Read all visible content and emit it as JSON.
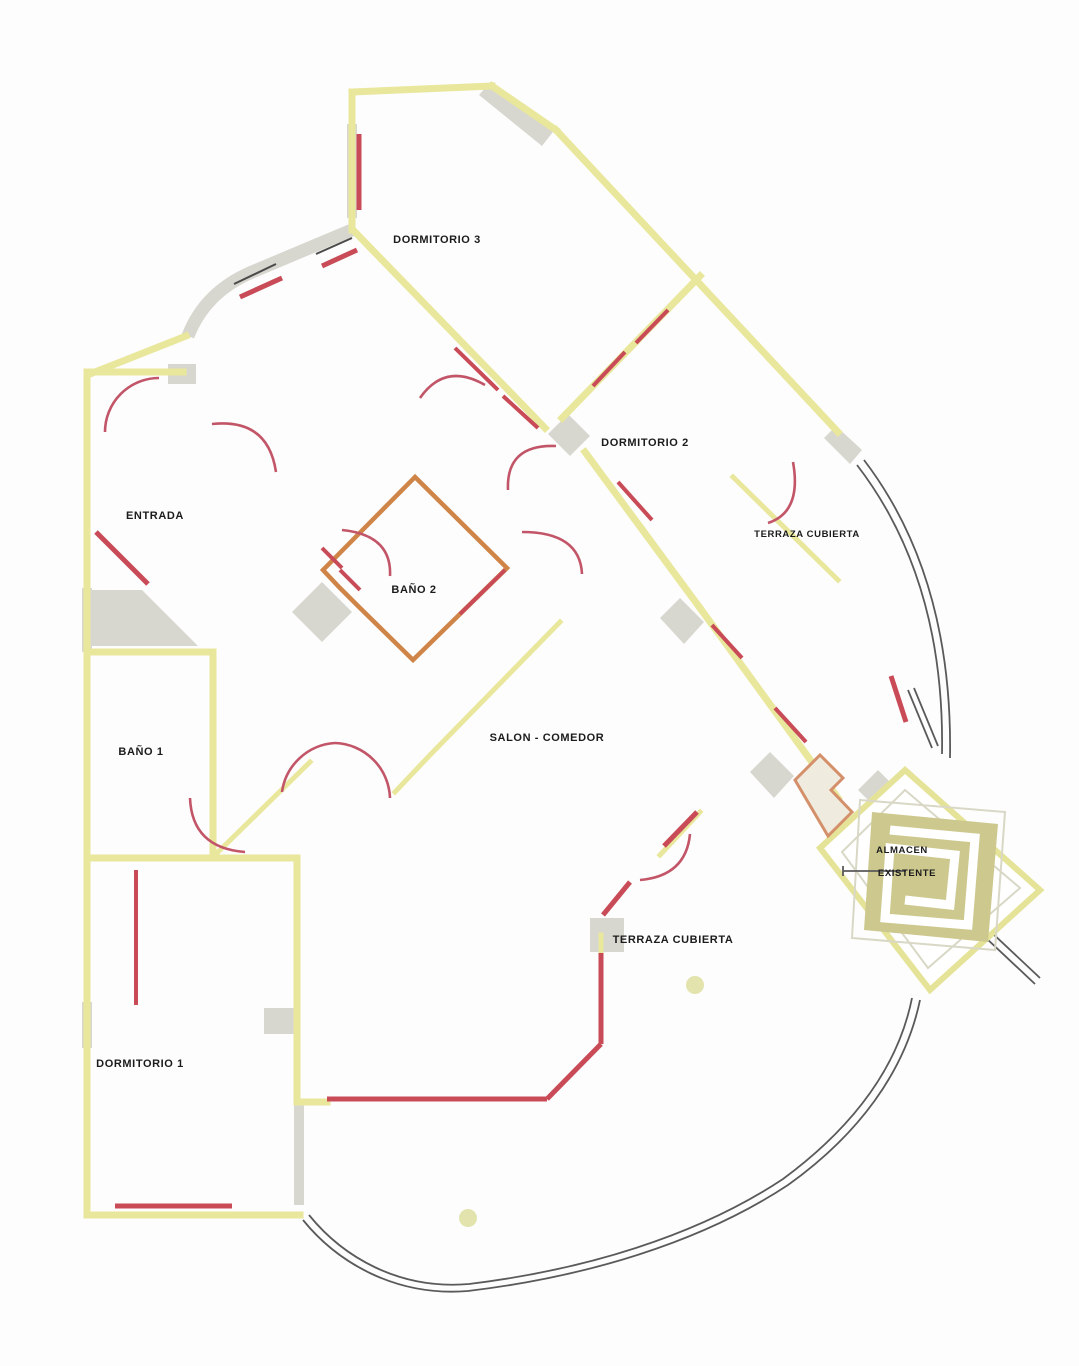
{
  "document": {
    "type": "architectural-floor-plan",
    "language": "es",
    "description": "Apartment floor plan with curved terrace"
  },
  "rooms": [
    {
      "id": "dormitorio-3",
      "label": "DORMITORIO 3"
    },
    {
      "id": "dormitorio-2",
      "label": "DORMITORIO 2"
    },
    {
      "id": "entrada",
      "label": "ENTRADA"
    },
    {
      "id": "bano-2",
      "label": "BAÑO 2"
    },
    {
      "id": "terraza-cubierta-superior",
      "label": "TERRAZA CUBIERTA"
    },
    {
      "id": "bano-1",
      "label": "BAÑO 1"
    },
    {
      "id": "salon-comedor",
      "label": "SALON - COMEDOR"
    },
    {
      "id": "terraza-cubierta-inferior",
      "label": "TERRAZA CUBIERTA"
    },
    {
      "id": "dormitorio-1",
      "label": "DORMITORIO 1"
    },
    {
      "id": "almacen",
      "label": "ALMACEN",
      "label2": "EXISTENTE"
    }
  ],
  "palette": {
    "wall_yellow": "#e9e79b",
    "accent_red": "#c84b57",
    "pier_gray": "#d8d7cf",
    "line_dark": "#4a4a4a",
    "olive_fill": "#cdc98e",
    "background": "#fdfdfd"
  }
}
